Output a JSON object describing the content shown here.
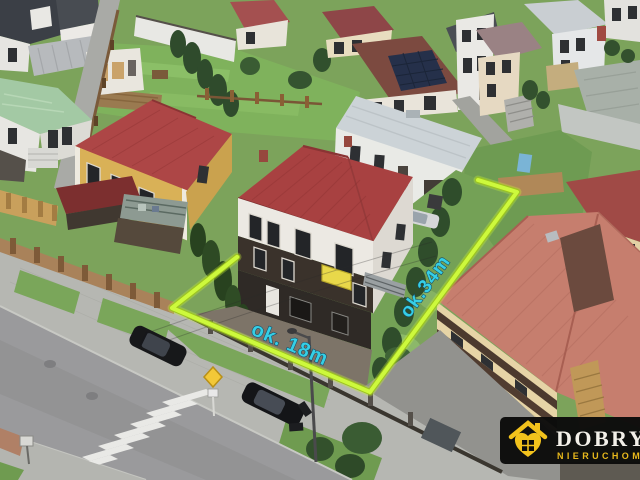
{
  "annotations": {
    "front_width_label": "ok. 18m",
    "side_length_label": "ok.34m",
    "boundary_color": "#c9f636",
    "label_color": "#35cfe6"
  },
  "watermark": {
    "brand": "DOBRY D",
    "brand_line2": "NIERUCHOM",
    "icon": "house-heart-icon",
    "bar_color": "#0b0b0b",
    "accent_color": "#f2c21c",
    "text_color": "#f3f0e9"
  },
  "palette": {
    "grass": "#7ca35b",
    "road": "#9a9a9c",
    "sidewalk": "#b6b7b2",
    "main_roof_red": "#a84141",
    "left_roof_red": "#ad4646",
    "salmon_roof": "#c67e6e",
    "annex_roof": "#ccd3d7",
    "mint_roof": "#a3c9a4",
    "yellow_wall": "#d9b157",
    "dark_facade": "#3a322b",
    "car_black": "#17181a"
  }
}
